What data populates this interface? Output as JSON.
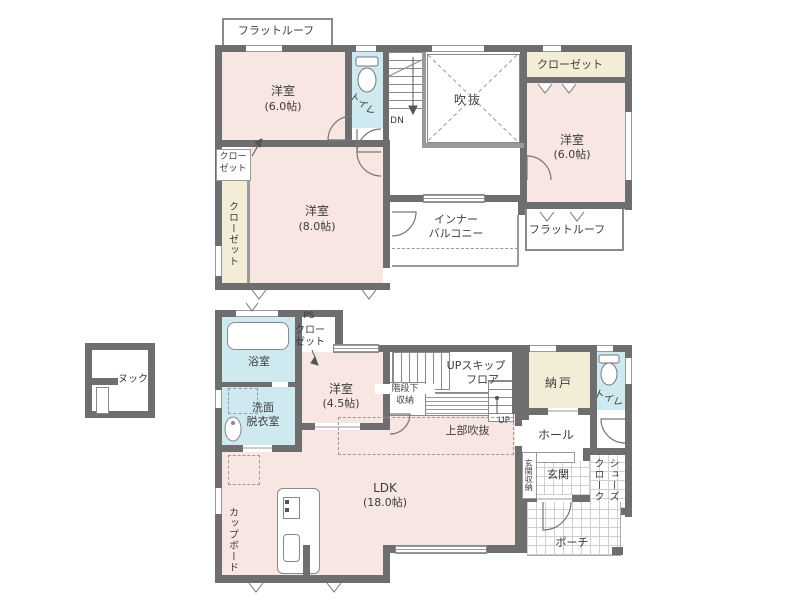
{
  "colors": {
    "wall": "#6e6e6e",
    "room_pink": "#f8e6e2",
    "wet_area_blue": "#cfe9f1",
    "closet_cream": "#f3edd7",
    "line_gray": "#8a8a8a"
  },
  "floor2": {
    "flat_roof_top": "フラットルーフ",
    "bedroom_nw_name": "洋室",
    "bedroom_nw_size": "(6.0帖)",
    "toilet": "トイレ",
    "stairs_down": "DN",
    "void": "吹抜",
    "closet_ne": "クローゼット",
    "bedroom_ne_name": "洋室",
    "bedroom_ne_size": "(6.0帖)",
    "closet_small_line1": "クロー",
    "closet_small_line2": "ゼット",
    "closet_west": "クローゼット",
    "bedroom_sw_name": "洋室",
    "bedroom_sw_size": "(8.0帖)",
    "inner_balcony_line1": "インナー",
    "inner_balcony_line2": "バルコニー",
    "flat_roof_se": "フラットルーフ"
  },
  "floor1": {
    "nook": "ヌック",
    "bath": "浴室",
    "washroom_line1": "洗面",
    "washroom_line2": "脱衣室",
    "pipe_space": "PS",
    "ps_closet_line1": "クロー",
    "ps_closet_line2": "ゼット",
    "bedroom_name": "洋室",
    "bedroom_size": "(4.5帖)",
    "under_stair_line1": "階段下",
    "under_stair_line2": "収納",
    "skip_floor_line1": "UPスキップ",
    "skip_floor_line2": "フロア",
    "stairs_up": "UP",
    "storage_room": "納戸",
    "toilet": "トイレ",
    "upper_void": "上部吹抜",
    "hall": "ホール",
    "entrance_storage": "玄関収納",
    "entrance": "玄関",
    "shoe_closet_line1": "シューズ",
    "shoe_closet_line2": "クローク",
    "porch": "ポーチ",
    "ldk_name": "LDK",
    "ldk_size": "(18.0帖)",
    "cupboard": "カップボード"
  }
}
